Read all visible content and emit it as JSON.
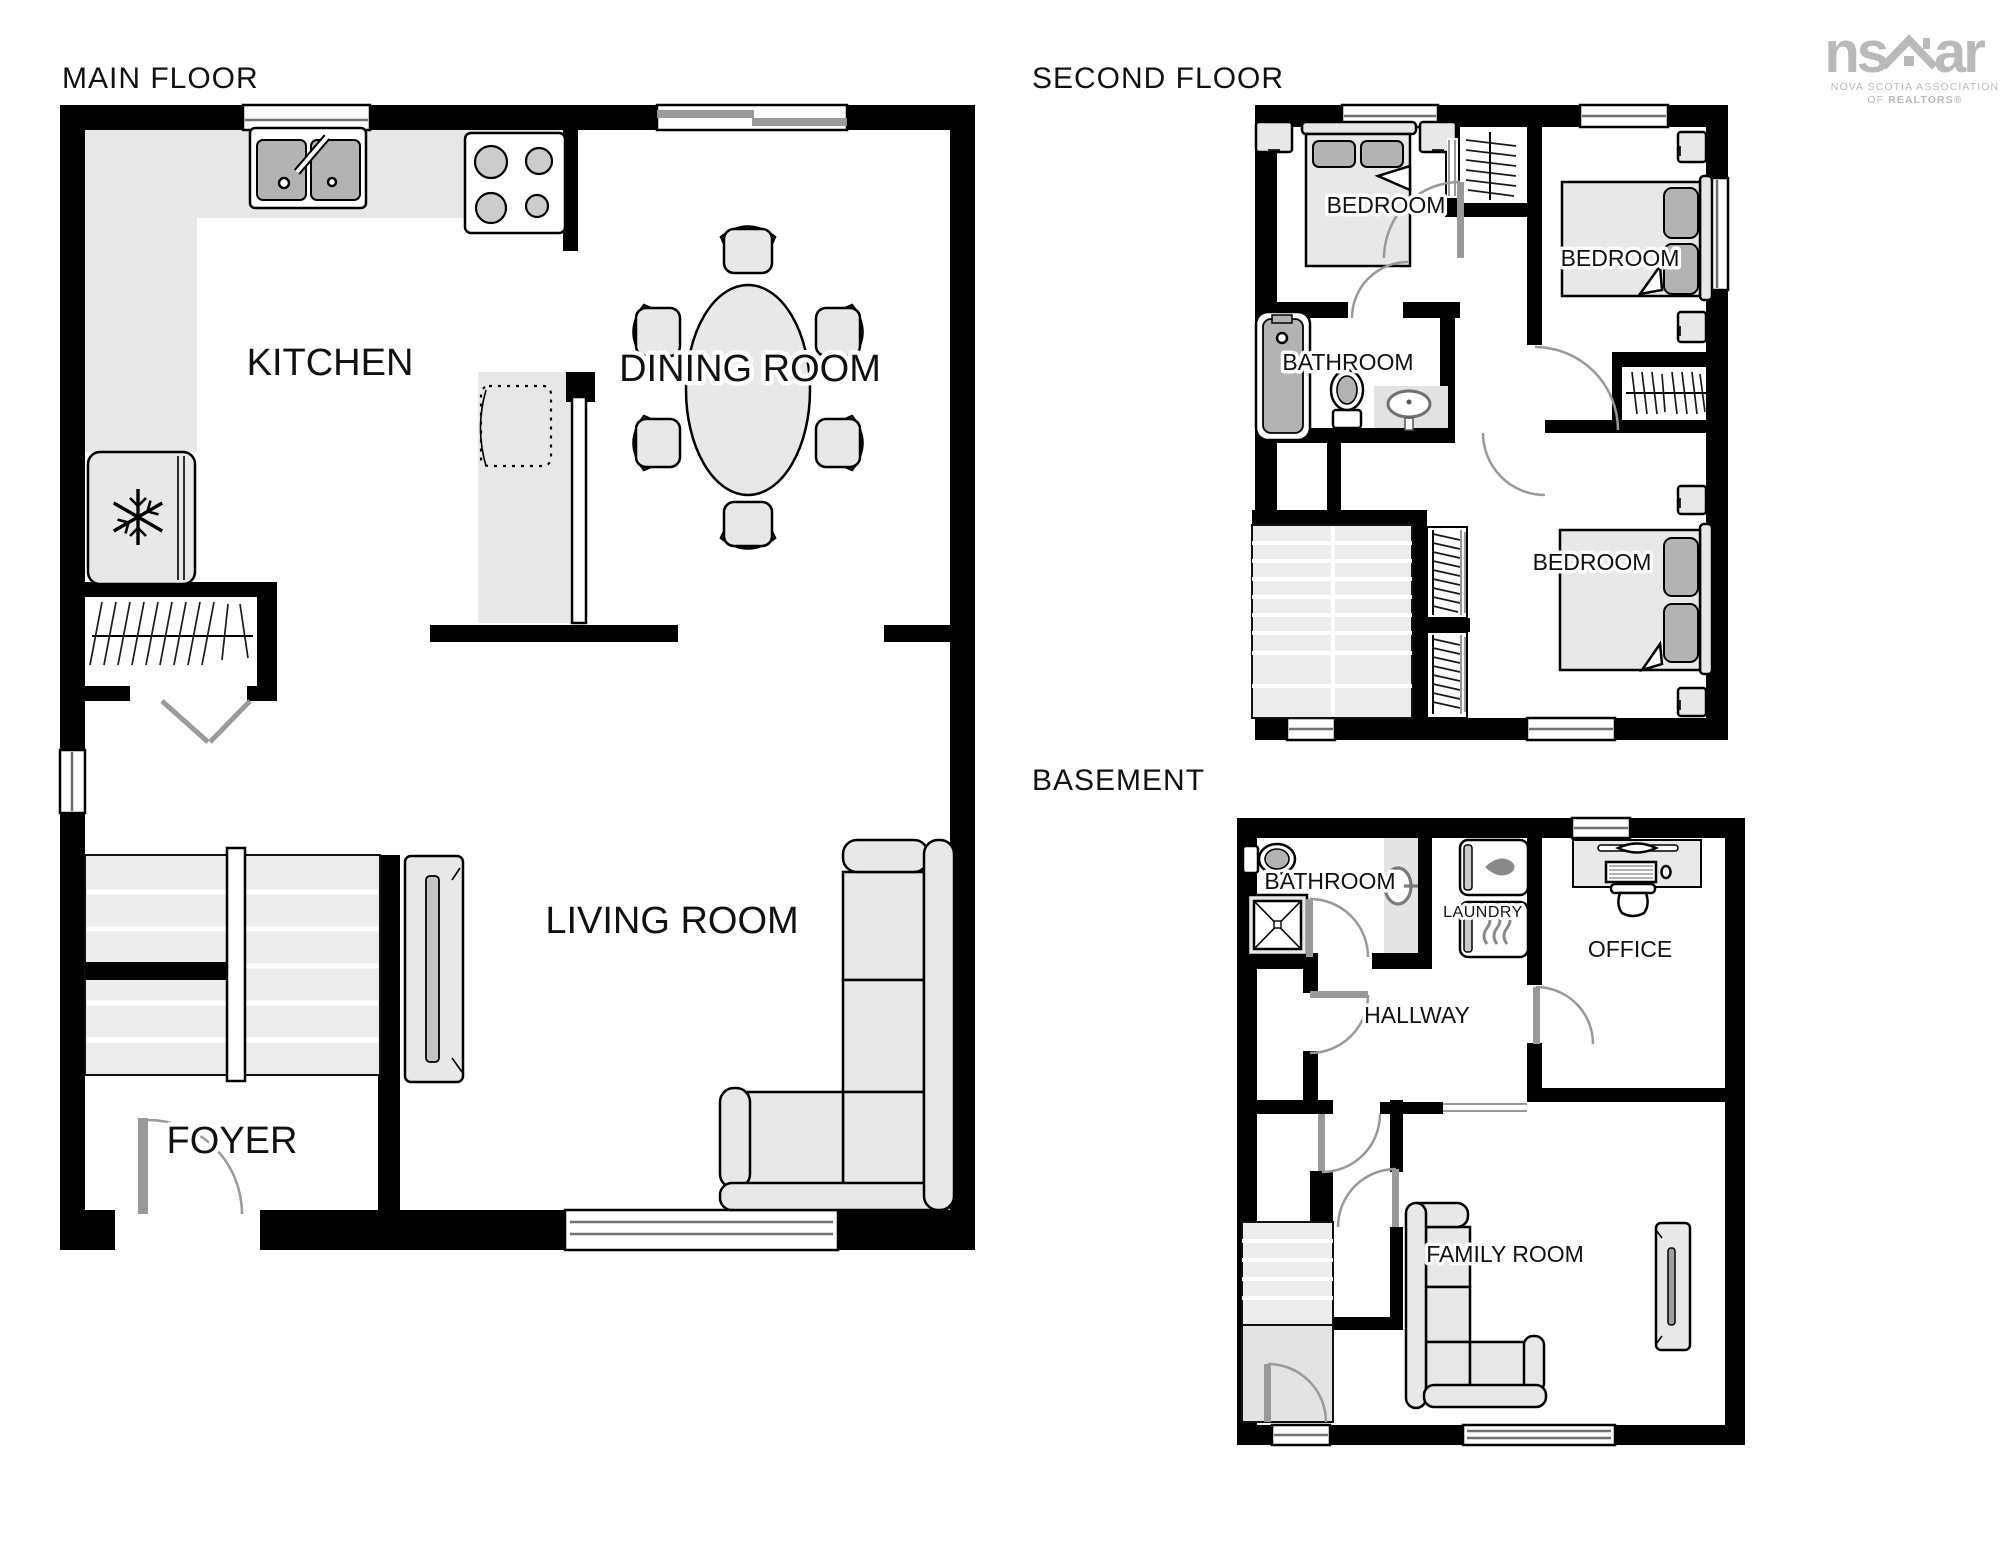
{
  "floors": {
    "main": {
      "title": "MAIN FLOOR",
      "rooms": {
        "kitchen": "KITCHEN",
        "dining": "DINING ROOM",
        "living": "LIVING ROOM",
        "foyer": "FOYER"
      }
    },
    "second": {
      "title": "SECOND FLOOR",
      "rooms": {
        "bedroom1": "BEDROOM",
        "bedroom2": "BEDROOM",
        "bathroom": "BATHROOM",
        "bedroom3": "BEDROOM"
      }
    },
    "basement": {
      "title": "BASEMENT",
      "rooms": {
        "bathroom": "BATHROOM",
        "laundry": "LAUNDRY",
        "hallway": "HALLWAY",
        "office": "OFFICE",
        "family": "FAMILY ROOM"
      }
    }
  },
  "logo": {
    "text_left": "ns",
    "text_right": "ar",
    "icon": "house-icon",
    "tagline_line1": "NOVA SCOTIA ASSOCIATION",
    "tagline_line2_prefix": "OF",
    "tagline_line2_brand": "REALTORS®"
  },
  "colors": {
    "wall": "#000000",
    "furniture": "#e8e8e8",
    "accent": "#b3b3b3",
    "line": "#000000",
    "door": "#999999",
    "window": "#707070",
    "logo": "#b9b9b9",
    "steps": "#ececec",
    "counter": "#e7e7e7"
  }
}
